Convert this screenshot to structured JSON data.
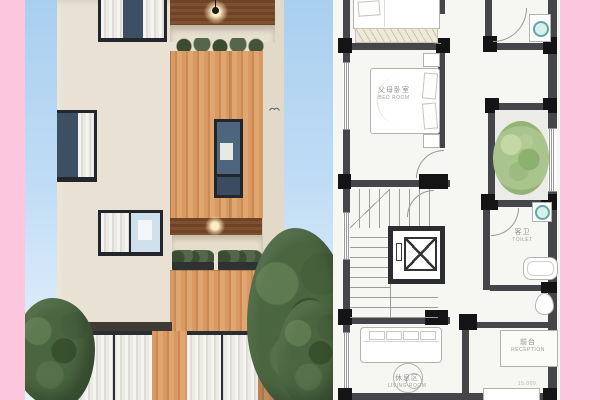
{
  "collage": {
    "description": "architectural presentation: facade render (left) and floor plan (right)",
    "background_color": "#fcc6dc"
  },
  "palette": {
    "pink_background": "#fcc6dc",
    "sky_blue": "#a9cfef",
    "facade_cream": "#e9e1d3",
    "wood_cladding": "#d89a62",
    "wood_soffit": "#6f4326",
    "window_glass": "#3d4f63",
    "foliage_green": "#4a6640",
    "plan_wall_gray": "#45464a",
    "plan_column_black": "#141416",
    "plan_tree_green": "#a9c48c",
    "fixture_teal": "#5fa7a3"
  },
  "floor_plan": {
    "rooms": [
      {
        "zh": "父母卧室",
        "en": "BED ROOM"
      },
      {
        "zh": "客卫",
        "en": "TOILET"
      },
      {
        "zh": "前台",
        "en": "RECEPTION"
      },
      {
        "zh": "休息区",
        "en": "LIVING ROOM"
      }
    ],
    "dimension_text": "15.000"
  }
}
